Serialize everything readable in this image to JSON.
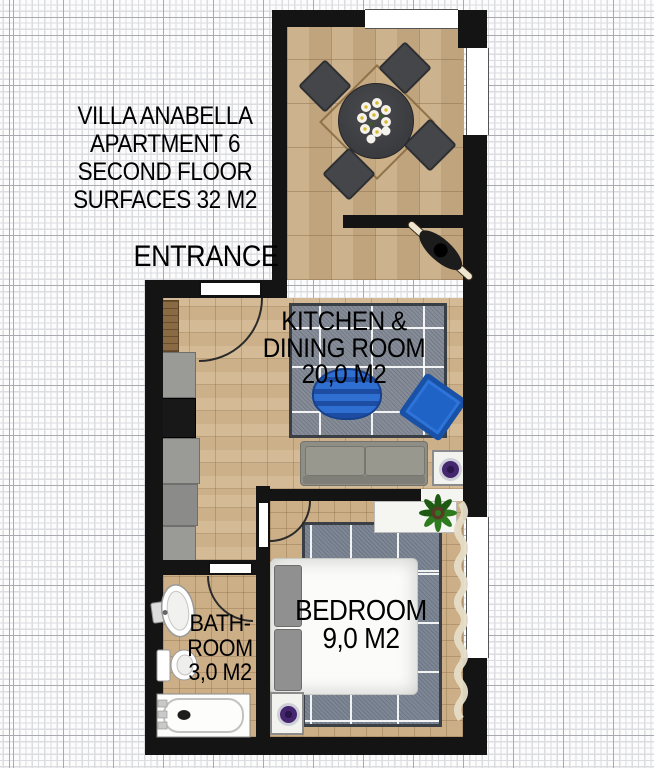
{
  "header": {
    "lines": [
      "VILLA ANABELLA",
      "APARTMENT 6",
      "SECOND FLOOR",
      "SURFACES 32 M2"
    ]
  },
  "labels": {
    "entrance": "ENTRANCE"
  },
  "rooms": {
    "kitchen_dining": {
      "line1": "KITCHEN &",
      "line2": "DINING ROOM",
      "area": "20,0 M2"
    },
    "bedroom": {
      "name": "BEDROOM",
      "area": "9,0 M2"
    },
    "bathroom": {
      "line1": "BATH-",
      "line2": "ROOM",
      "area": "3,0 M2"
    }
  },
  "furniture": {
    "terrace": [
      "dining-table",
      "dining-chairs",
      "flower-centerpiece"
    ],
    "hallway": [
      "decor-item"
    ],
    "kitchen_dining": [
      "kitchen-counter",
      "cooktop",
      "sofa",
      "bean-bag",
      "armchair",
      "side-table",
      "rug"
    ],
    "bedroom": [
      "double-bed",
      "pillows",
      "dresser",
      "potted-plant",
      "stool",
      "rug",
      "curtain"
    ],
    "bathroom": [
      "sink",
      "toilet",
      "bathtub"
    ]
  },
  "colors": {
    "paper": "#fcfcfd",
    "grid-minor": "#dcdde1",
    "grid-major": "#a9aab0",
    "wall": "#141414",
    "floor": "#d2b790",
    "floor-terrace": "#c9ad86",
    "floor-bath": "#ccae87",
    "rug": "#868d98",
    "rug-bed": "#7e8795",
    "sofa": "#8e8e87",
    "accent-blue": "#2063c6",
    "accent-purple": "#45276f",
    "counter": "#9a9a97",
    "wood": "#8a6a42",
    "bed": "#fbfbfa"
  }
}
